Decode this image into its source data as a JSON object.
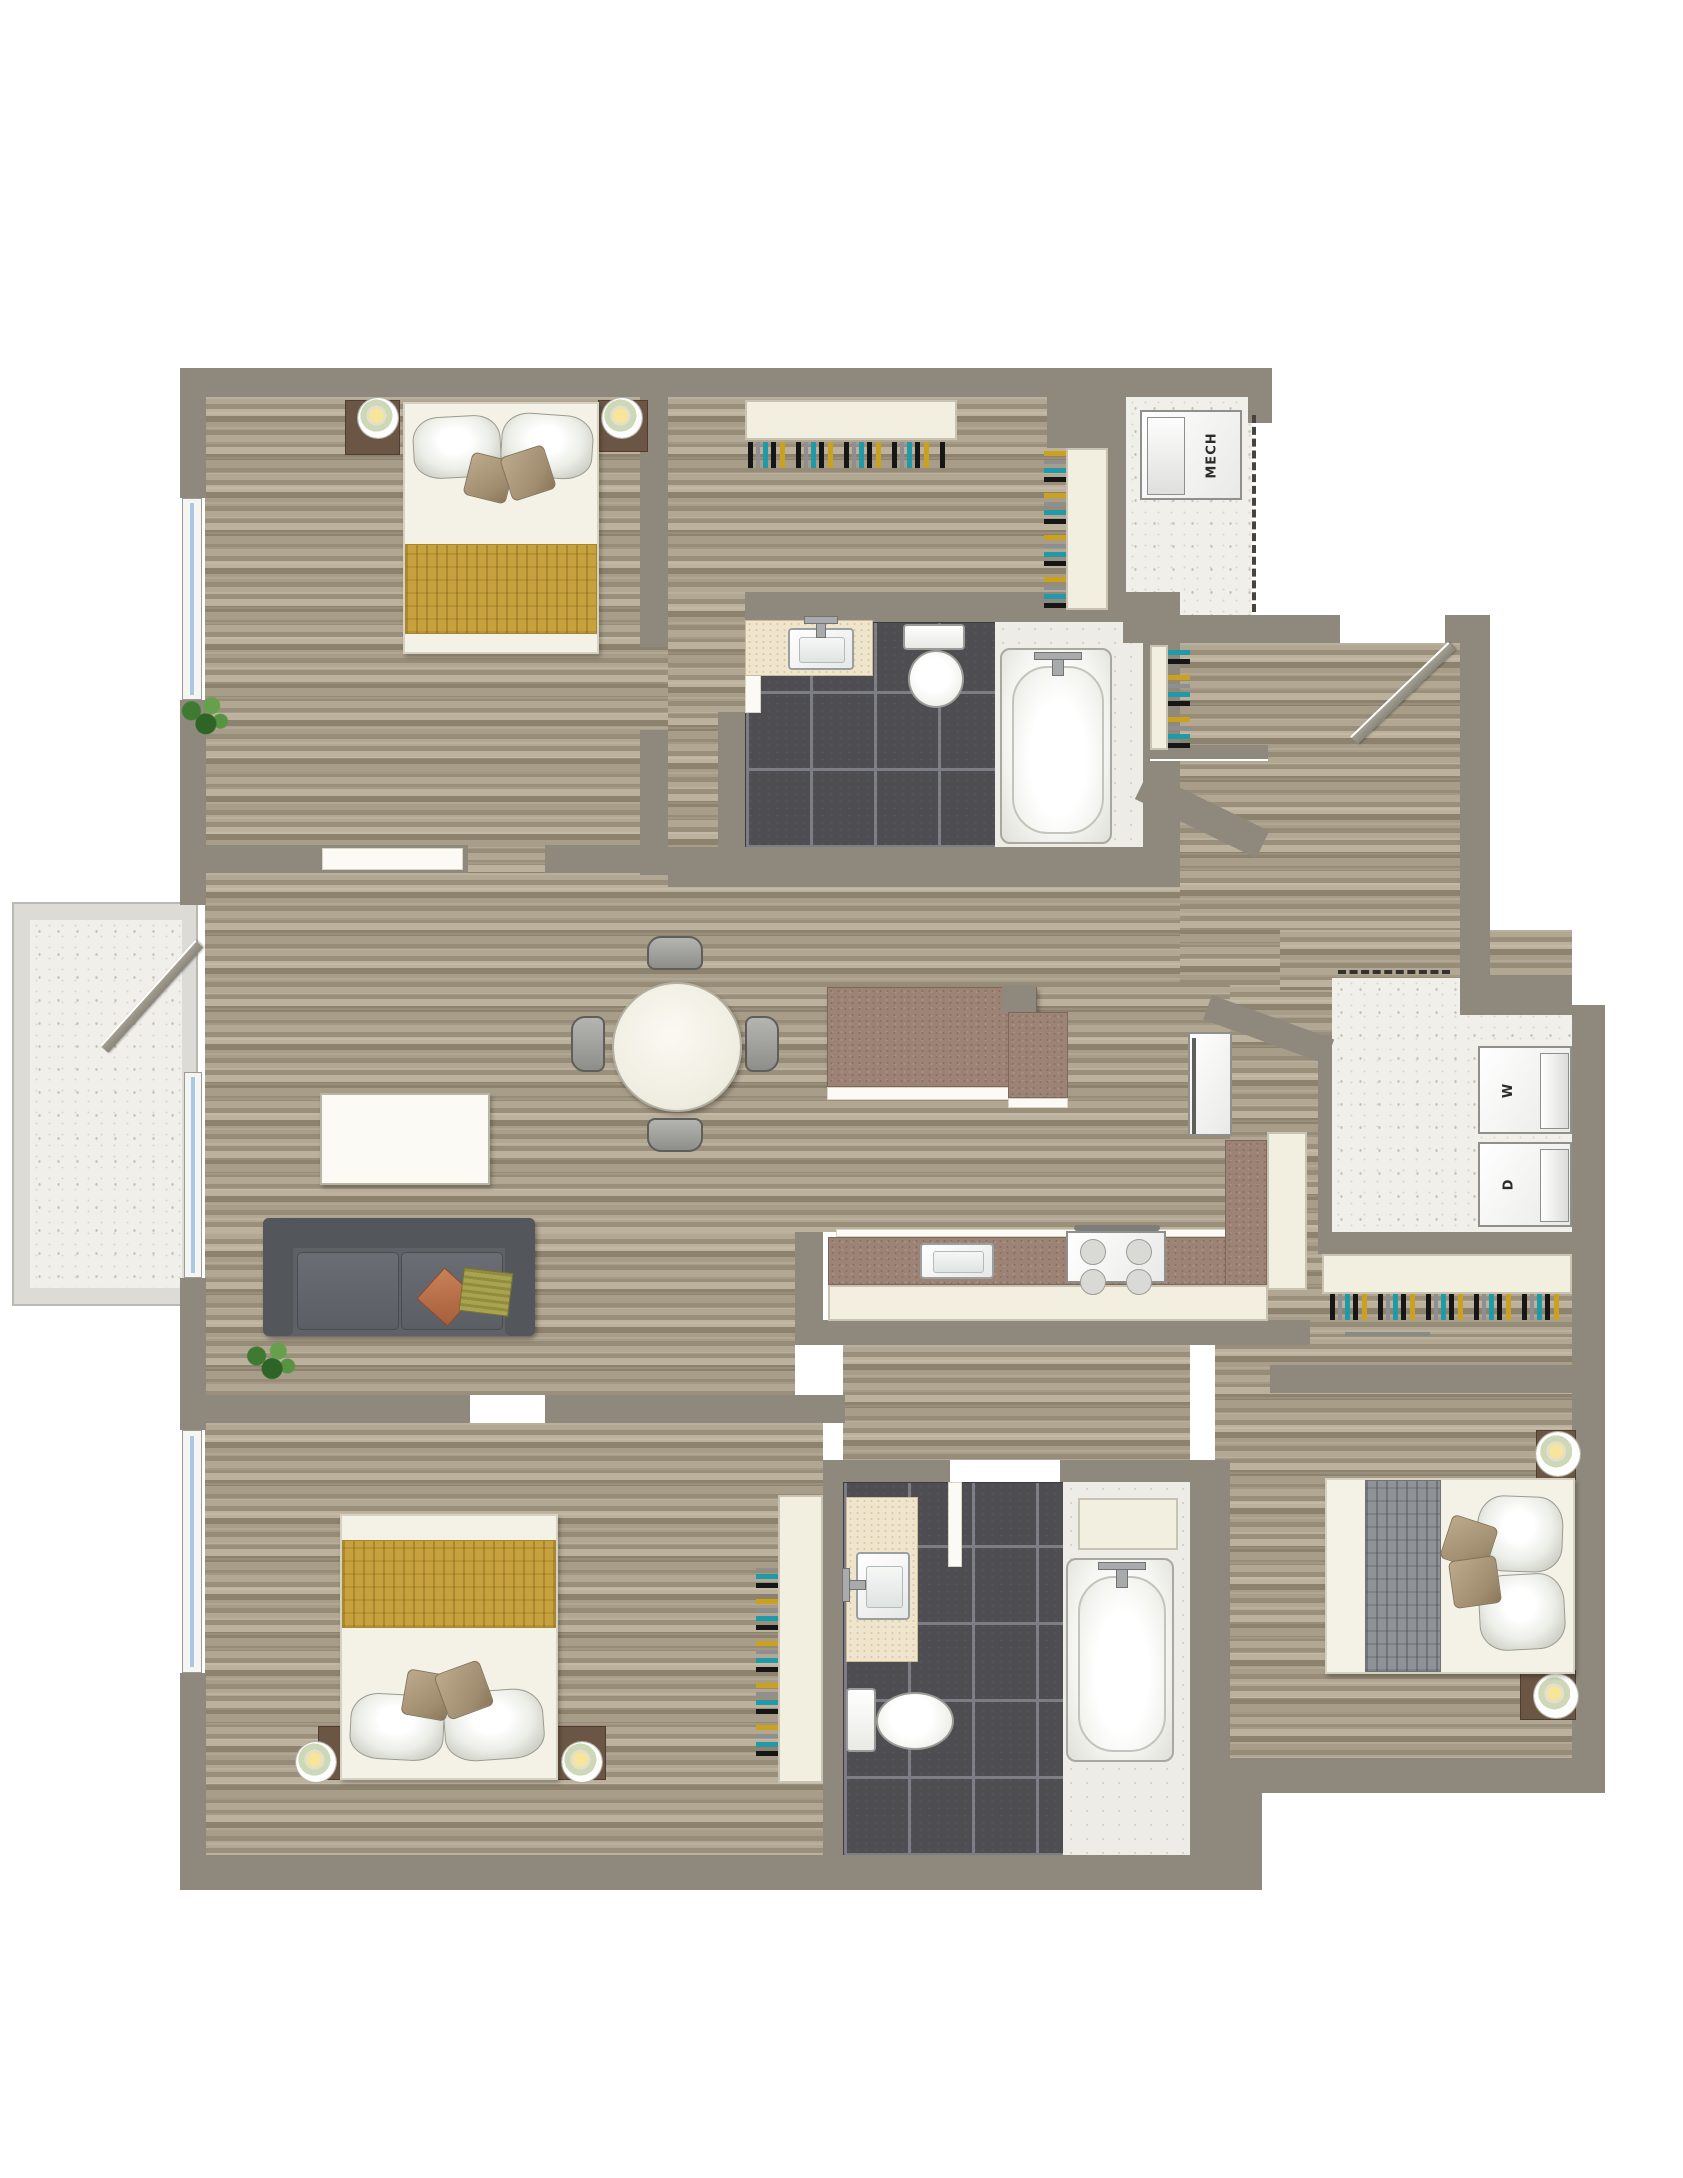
{
  "plan": {
    "type": "apartment-floor-plan",
    "labels": {
      "mech": "MECH",
      "washer": "W",
      "dryer": "D"
    },
    "rooms": [
      "bedroom-1",
      "walk-in-closet",
      "bathroom-1",
      "mech-closet",
      "entry-hall",
      "living-dining",
      "kitchen",
      "laundry-closet",
      "hall-closet",
      "balcony",
      "bedroom-2",
      "bathroom-2",
      "bedroom-3"
    ],
    "furniture": [
      "queen-bed",
      "nightstand",
      "table-lamp",
      "round-dining-table",
      "dining-chair",
      "media-console",
      "sofa",
      "coffee-table",
      "kitchen-sink",
      "stove",
      "refrigerator",
      "washer",
      "dryer",
      "toilet",
      "bathtub",
      "vanity-sink",
      "hanger-rod",
      "plant"
    ],
    "palette": {
      "wall": "#8E897C",
      "wood_light": "#B2A793",
      "wood_dark": "#8D826D",
      "tile": "#4E4E52",
      "grout": "#7D7D85",
      "cream": "#F2EFE1",
      "counter_brown": "#9C8376",
      "blanket_gold": "#C7A13D",
      "blanket_gray": "#8F9397",
      "sofa_gray": "#5E6266",
      "lamp_green": "#CCD8B8",
      "lamp_yellow": "#F7E59A",
      "hanger_teal": "#1F9AA8",
      "hanger_yellow": "#CCA11D",
      "window_blue": "#AAC7E4",
      "speckle_floor": "#F0EFE9"
    }
  }
}
